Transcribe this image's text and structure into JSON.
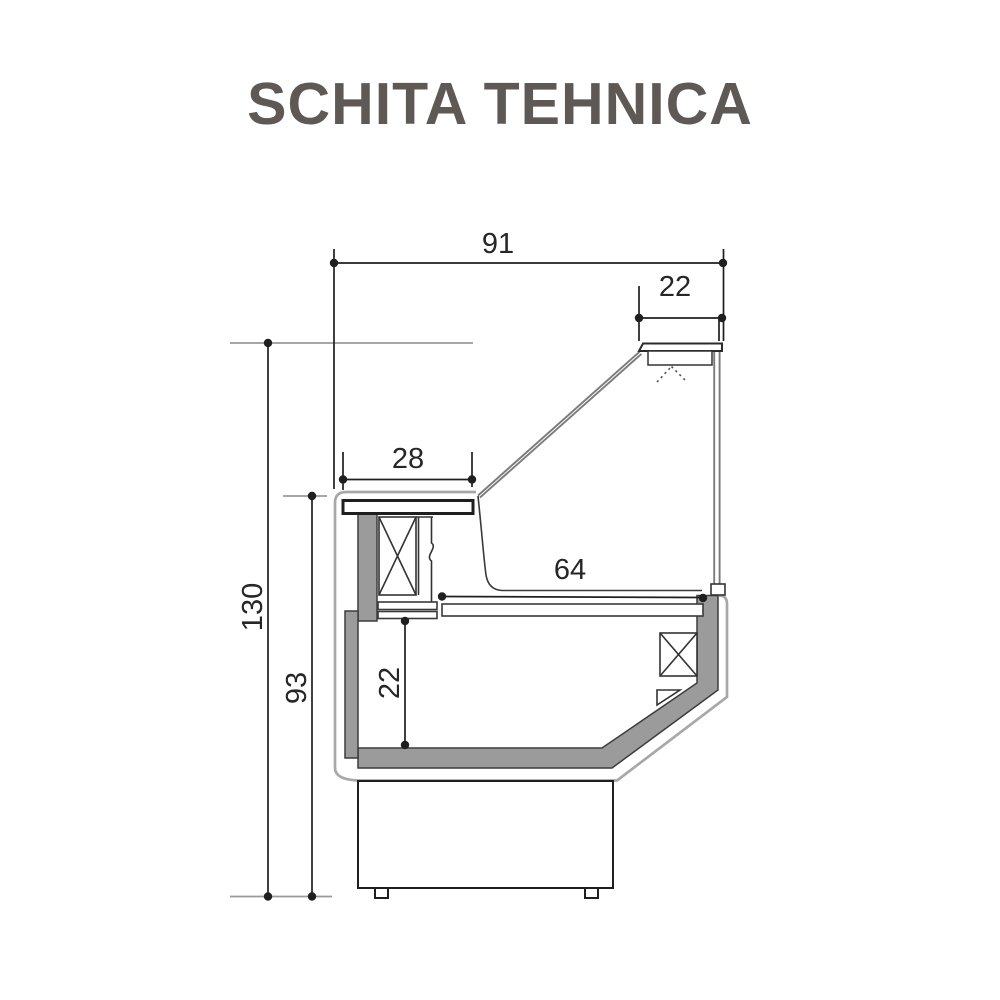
{
  "title": "SCHITA TEHNICA",
  "drawing": {
    "type": "refrigerated-display-case-cross-section",
    "dimensions": {
      "overall_width": "91",
      "top_depth": "22",
      "counter_width": "28",
      "display_deck_width": "64",
      "overall_height": "130",
      "worktop_height": "93",
      "well_height": "22"
    },
    "colors": {
      "line": "#1f1f1f",
      "outer": "#a8a8a8",
      "panel": "#9b9b9b",
      "ref": "#9a9a9a",
      "glass": "#7b7b7b",
      "dim_text": "#262626",
      "title": "#5e5955"
    }
  }
}
